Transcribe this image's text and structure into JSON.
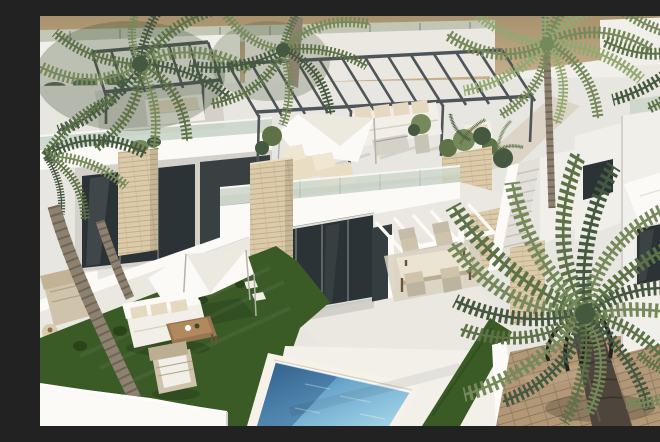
{
  "scene": {
    "description": "Aerial 3D architectural render of modern white villas with rooftop terraces, a steel pergola, shade sails, landscaped lawns, palm trees and a private swimming pool",
    "type": "3d-architectural-render"
  },
  "palette": {
    "sand": "#c9b390",
    "sand_dark": "#a8926d",
    "ground": "#e8e6e1",
    "wall": "#f1efe9",
    "wall_bright": "#fbfaf6",
    "wall_warm": "#ebe8e1",
    "wall_shadow": "#d4d1ca",
    "terrace": "#dcd5c7",
    "glass_dark": "#2b3336",
    "glass_frame": "#dfe0da",
    "balustrade": "#c8d4c6",
    "steel": "#4e5559",
    "stone": "#dccbaa",
    "stone_line": "#c2ae88",
    "grass": "#3a5a26",
    "grass_dark": "#2a431a",
    "grass_light": "#4c7030",
    "pool_deep": "#2f5e8a",
    "pool_mid": "#6aa6cc",
    "pool_light": "#a9d9ea",
    "curb": "#f6f2e9",
    "wood": "#9a7650",
    "wood_dark": "#6e5236",
    "cushion": "#e6d9c2",
    "fabric": "#f2efe8",
    "wicker": "#cfc3ab",
    "sail": "#fbfaf7",
    "palm1": "#5d7247",
    "palm2": "#76895a",
    "palm3": "#455840",
    "palm_light": "#93a871",
    "trunk": "#8d8170",
    "trunk_dark": "#6f6455",
    "trunk_big": "#4e463c",
    "brick": "#b39878",
    "brick_line": "#8f7a5f"
  }
}
